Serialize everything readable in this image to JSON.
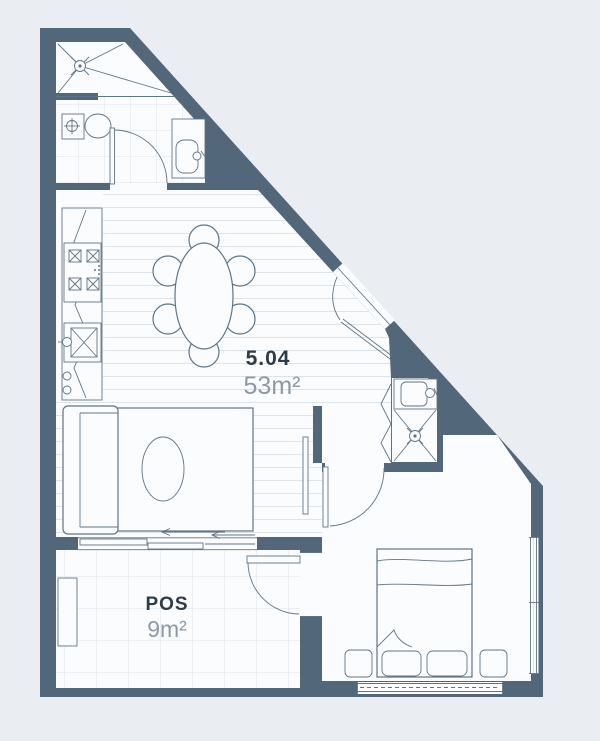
{
  "labels": {
    "unit_number": "5.04",
    "unit_area": "53m²",
    "pos": "POS",
    "pos_area": "9m²"
  },
  "colors": {
    "wall": "#52677a",
    "background": "#eaeef2",
    "floor": "#fbfcfd",
    "line": "#5f7587",
    "grid": "#dce3e9",
    "text_dark": "#2e3c48",
    "text_light": "#8d99a6"
  },
  "rooms": [
    "shower",
    "bathroom",
    "kitchen",
    "living-dining",
    "hall",
    "ensuite",
    "bedroom",
    "pos-terrace"
  ],
  "fixtures": [
    "shower-drain",
    "toilet",
    "vanity-basin",
    "bathroom-door",
    "kitchen-counter",
    "cooktop",
    "kitchen-sink",
    "dining-table",
    "dining-chair",
    "entry-door",
    "sofa",
    "rug",
    "coffee-table",
    "tv",
    "sliding-door",
    "bifold-door",
    "ensuite-basin",
    "ensuite-shower-drain",
    "bedroom-door",
    "bed",
    "pillow",
    "bedside-table",
    "window",
    "planter",
    "pos-door"
  ]
}
